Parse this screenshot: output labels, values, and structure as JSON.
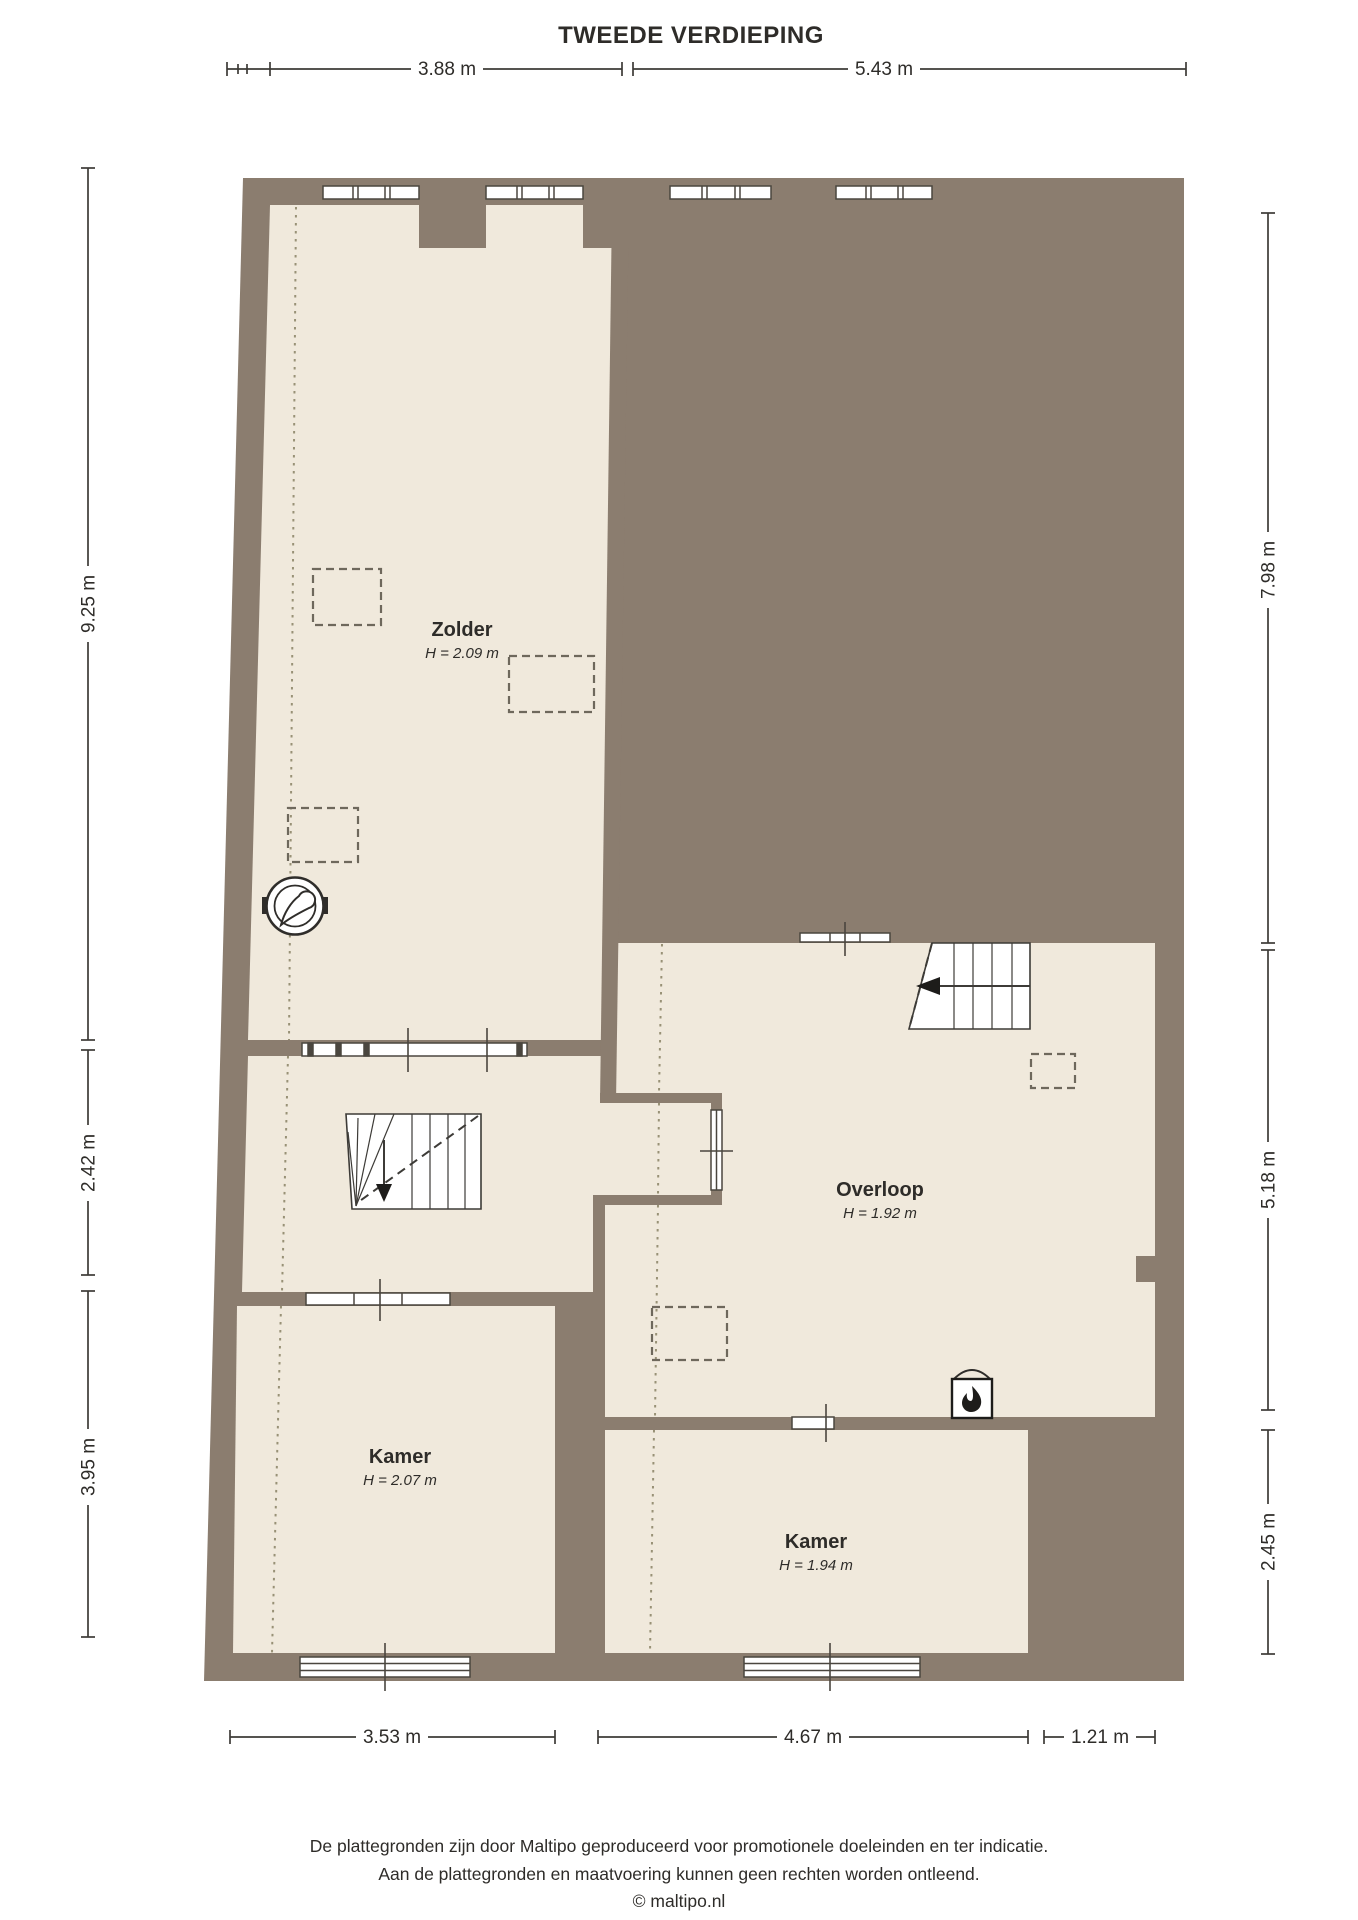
{
  "title": "TWEEDE VERDIEPING",
  "colors": {
    "wall": "#8b7d6f",
    "floor": "#f0e9dc",
    "window_frame": "#4a463f",
    "dim_line": "#3d3b37",
    "text": "#2e2c29"
  },
  "dims": {
    "top": [
      {
        "label": "3.88 m"
      },
      {
        "label": "5.43 m"
      }
    ],
    "left": [
      {
        "label": "9.25 m"
      },
      {
        "label": "2.42 m"
      },
      {
        "label": "3.95 m"
      }
    ],
    "right": [
      {
        "label": "7.98 m"
      },
      {
        "label": "5.18 m"
      },
      {
        "label": "2.45 m"
      }
    ],
    "bottom": [
      {
        "label": "3.53 m"
      },
      {
        "label": "4.67 m"
      },
      {
        "label": "1.21 m"
      }
    ]
  },
  "rooms": {
    "zolder": {
      "name": "Zolder",
      "height": "H = 2.09 m"
    },
    "overloop": {
      "name": "Overloop",
      "height": "H = 1.92 m"
    },
    "kamer_left": {
      "name": "Kamer",
      "height": "H = 2.07 m"
    },
    "kamer_right": {
      "name": "Kamer",
      "height": "H = 1.94 m"
    }
  },
  "icons": {
    "boiler": "boiler-icon",
    "stove": "stove-fireplace-icon",
    "stairs_left": "stairs-down-icon",
    "stairs_right": "stairs-down-icon"
  },
  "footer": {
    "line1": "De plattegronden zijn door Maltipo geproduceerd voor promotionele doeleinden en ter indicatie.",
    "line2": "Aan de plattegronden en maatvoering kunnen geen rechten worden ontleend.",
    "line3": "© maltipo.nl"
  }
}
